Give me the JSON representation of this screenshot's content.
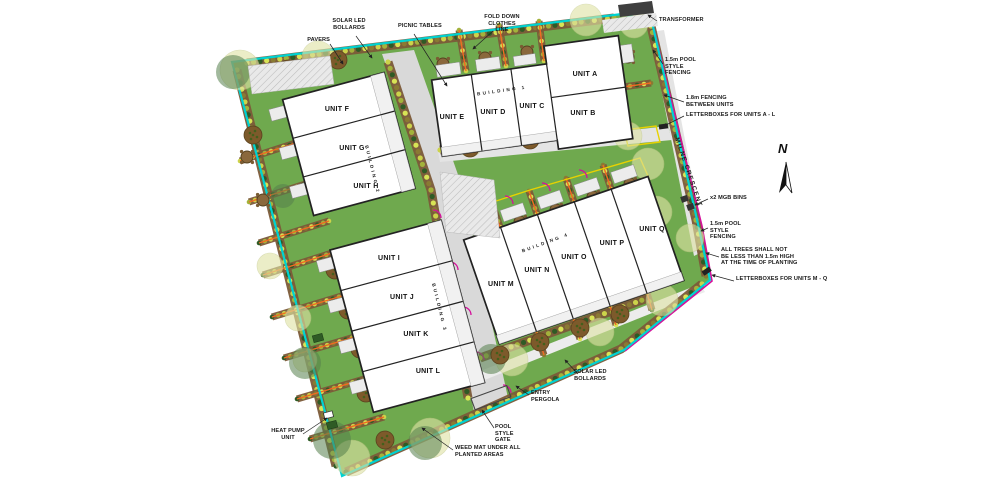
{
  "plan": {
    "street": "MILNE CRESCENT",
    "north_label": "N",
    "buildings": [
      {
        "label": "BUILDING 1"
      },
      {
        "label": "BUILDING 2"
      },
      {
        "label": "BUILDING 3"
      },
      {
        "label": "BUILDING 4"
      }
    ],
    "units": [
      {
        "label": "UNIT A"
      },
      {
        "label": "UNIT B"
      },
      {
        "label": "UNIT C"
      },
      {
        "label": "UNIT D"
      },
      {
        "label": "UNIT E"
      },
      {
        "label": "UNIT F"
      },
      {
        "label": "UNIT G"
      },
      {
        "label": "UNIT H"
      },
      {
        "label": "UNIT I"
      },
      {
        "label": "UNIT J"
      },
      {
        "label": "UNIT K"
      },
      {
        "label": "UNIT L"
      },
      {
        "label": "UNIT M"
      },
      {
        "label": "UNIT N"
      },
      {
        "label": "UNIT O"
      },
      {
        "label": "UNIT P"
      },
      {
        "label": "UNIT Q"
      }
    ],
    "annotations": {
      "pavers": "PAVERS",
      "solar_top": "SOLAR LED\nBOLLARDS",
      "picnic": "PICNIC TABLES",
      "clothes": "FOLD DOWN\nCLOTHES LINE",
      "transformer": "TRANSFORMER",
      "fence_top": "1.5m POOL\nSTYLE\nFENCING",
      "fence_between": "1.8m FENCING\nBETWEEN UNITS",
      "letterboxes_al": "LETTERBOXES FOR UNITS A - L",
      "bins": "x2 MGB BINS",
      "fence_mid": "1.5m POOL\nSTYLE\nFENCING",
      "trees_note": "ALL TREES SHALL NOT\nBE LESS THAN 1.5m HIGH\nAT THE TIME OF PLANTING",
      "letterboxes_mq": "LETTERBOXES FOR UNITS M - Q",
      "solar_bottom": "SOLAR LED\nBOLLARDS",
      "entry": "ENTRY\nPERGOLA",
      "gate": "POOL\nSTYLE\nGATE",
      "weed": "WEED MAT UNDER ALL\nPLANTED AREAS",
      "heat": "HEAT PUMP\nUNIT"
    },
    "colors": {
      "boundary": "#00d2d2",
      "grass": "#6fa94e",
      "road": "#d9d9d9",
      "path": "#e4e4e4",
      "bed": "#7b5a38",
      "shrub1": "#ccd34a",
      "shrub2": "#a3b23b",
      "shrub3": "#2f5b25",
      "shrub4": "#d8e455",
      "shrub5": "#8a7a33",
      "fence_orange": "#f26a22",
      "fence_magenta": "#d4109a",
      "fence_yellow": "#e8d200",
      "tree": "#7d5a2b",
      "canopy_pale": "#dfe3a6",
      "canopy_dark": "#55804d"
    }
  }
}
